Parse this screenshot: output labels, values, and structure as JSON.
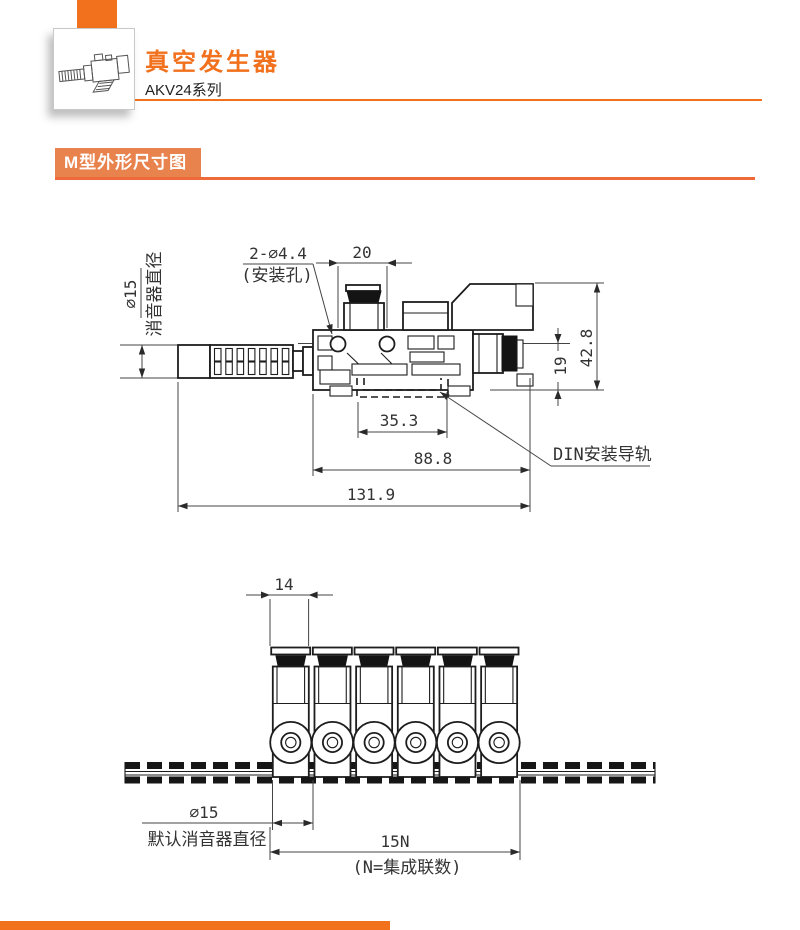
{
  "colors": {
    "brand_orange": "#F1711D",
    "badge_bg": "#E8834E",
    "badge_rule": "#EF6A3A",
    "drawing_line": "#1D1D1D"
  },
  "header": {
    "title": "真空发生器",
    "subtitle": "AKV24系列"
  },
  "section": {
    "badge_label": "M型外形尺寸图"
  },
  "drawing_top": {
    "mount_holes_dim": "2-∅4.4",
    "mount_holes_note": "(安装孔)",
    "hole_pitch": "20",
    "muffler_dia": "∅15",
    "muffler_label": "消音器直径",
    "total_height": "42.8",
    "port_height": "19",
    "clip_width": "35.3",
    "body_length": "88.8",
    "total_length": "131.9",
    "din_rail_label": "DIN安装导轨"
  },
  "drawing_bottom": {
    "unit_width": "14",
    "muffler_dia": "∅15",
    "muffler_label": "默认消音器直径",
    "total_width": "15N",
    "total_width_note": "(N=集成联数)"
  }
}
